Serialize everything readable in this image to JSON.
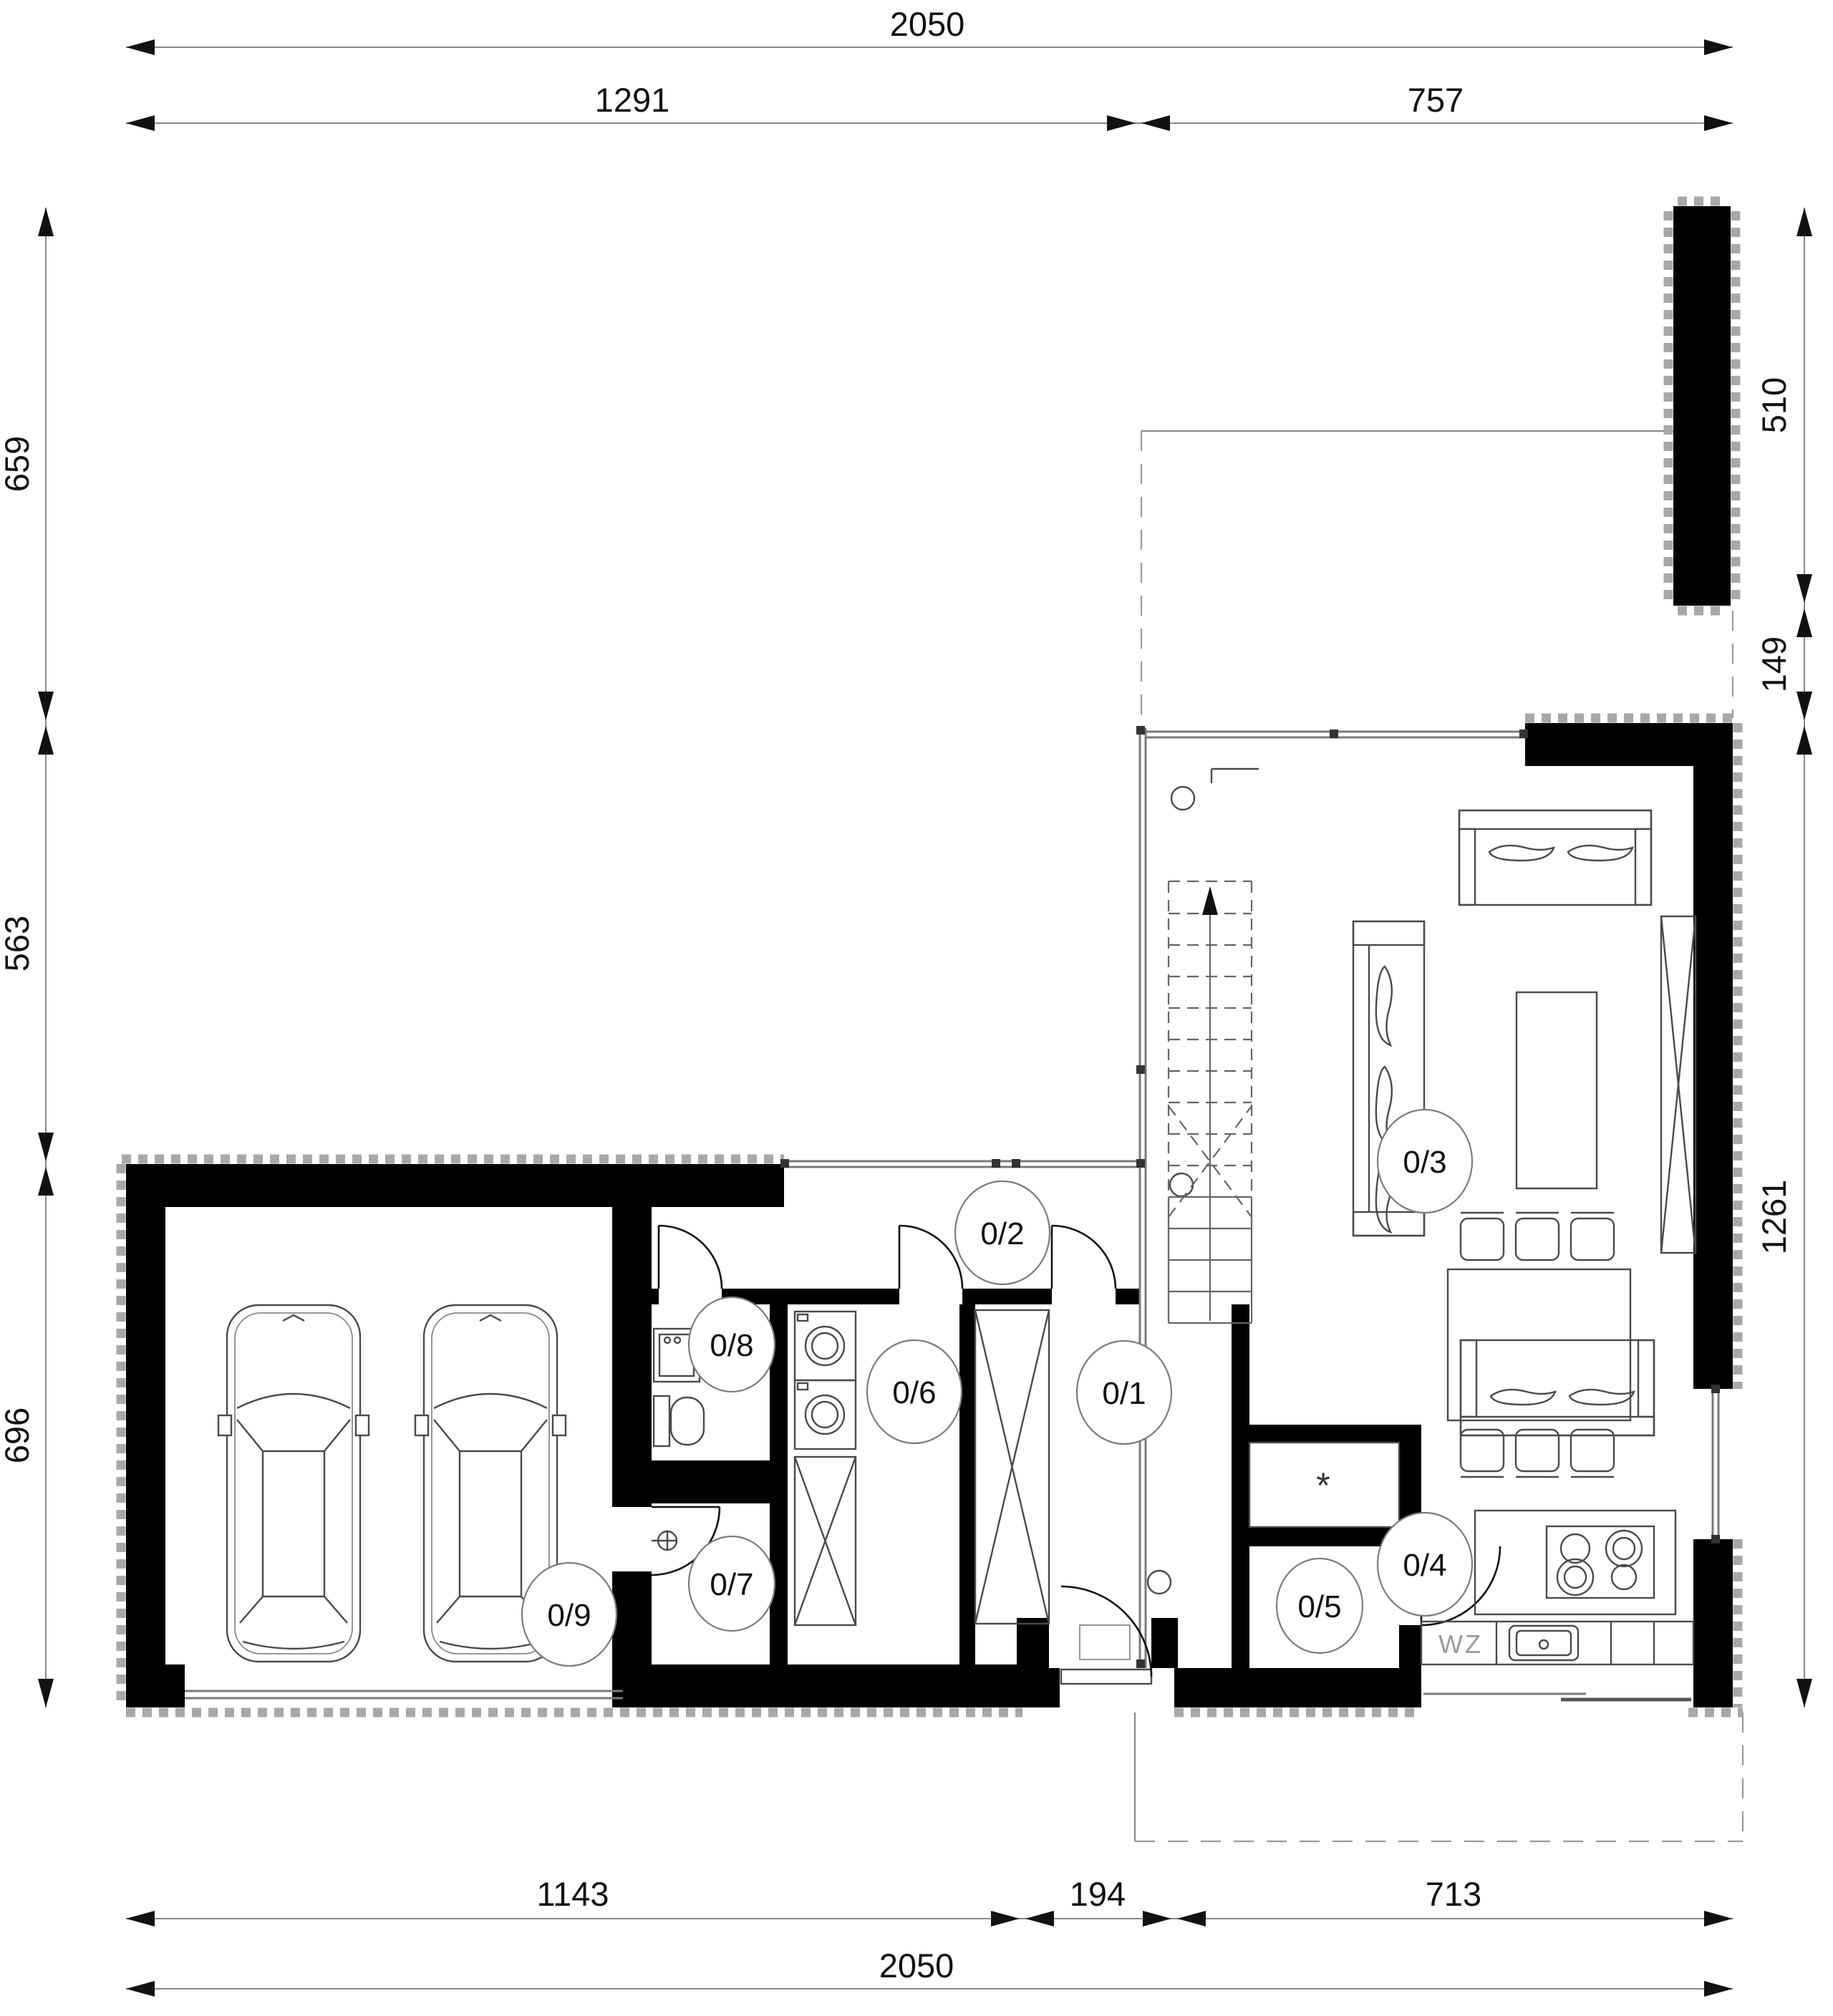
{
  "dims": {
    "top_overall": "2050",
    "top_left": "1291",
    "top_right": "757",
    "left_top": "659",
    "left_mid": "563",
    "left_bottom": "696",
    "right_top": "510",
    "right_mid": "149",
    "right_bottom": "1261",
    "bottom_left": "1143",
    "bottom_mid": "194",
    "bottom_right": "713",
    "bottom_overall": "2050"
  },
  "rooms": {
    "r01": "0/1",
    "r02": "0/2",
    "r03": "0/3",
    "r04": "0/4",
    "r05": "0/5",
    "r06": "0/6",
    "r07": "0/7",
    "r08": "0/8",
    "r09": "0/9"
  },
  "annotations": {
    "water_meter": "WZ",
    "closet_star": "*"
  },
  "colors": {
    "wall": "#000000",
    "furniture_line": "#4a4a4a",
    "glass_line": "#7a7a7a",
    "insulation": "#a8a8a8",
    "dimension_text": "#111111"
  }
}
